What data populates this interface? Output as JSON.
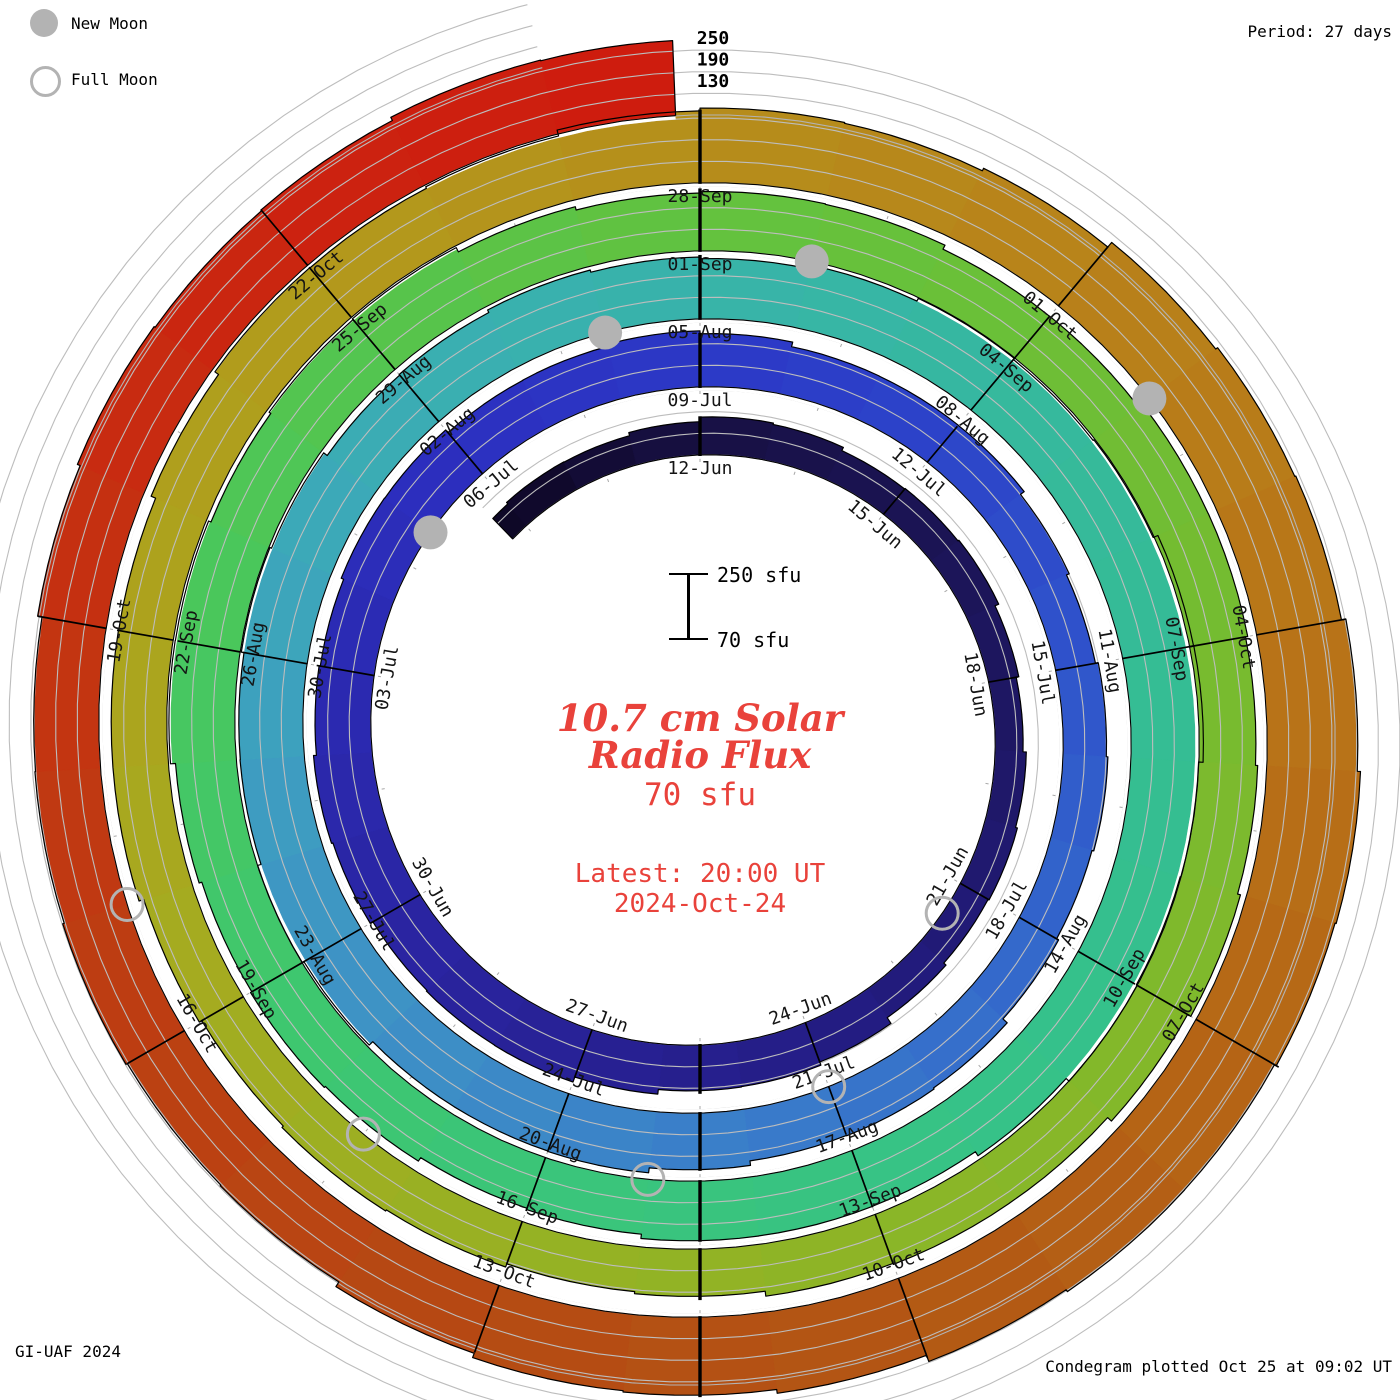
{
  "header": {
    "period_label": "Period: 27 days"
  },
  "legend": {
    "new_moon_label": "New Moon",
    "full_moon_label": "Full Moon"
  },
  "footer": {
    "left": "GI-UAF 2024",
    "right": "Condegram plotted Oct 25 at 09:02 UT"
  },
  "center": {
    "title_line1": "10.7 cm Solar",
    "title_line2": "Radio Flux",
    "baseline_value": "70 sfu",
    "latest_line1": "Latest: 20:00 UT",
    "latest_line2": "2024-Oct-24",
    "accent_color": "#e9423b"
  },
  "scale_bar": {
    "top_label": "250 sfu",
    "bottom_label": "70 sfu",
    "min_sfu": 70,
    "max_sfu": 250
  },
  "chart_data": {
    "type": "spiral",
    "title": "10.7 cm Solar Radio Flux condegram",
    "period_days": 27,
    "start_reference_date": "2024-06-12",
    "t_start": -3.3,
    "t_end": 134.83,
    "flux_min": 70,
    "flux_max": 250,
    "radial_axis_labels": [
      "250",
      "190",
      "130"
    ],
    "flux_keyframes": [
      [
        -3,
        150
      ],
      [
        0,
        172
      ],
      [
        3,
        162
      ],
      [
        6,
        152
      ],
      [
        9,
        162
      ],
      [
        12,
        188
      ],
      [
        15,
        212
      ],
      [
        18,
        228
      ],
      [
        21,
        232
      ],
      [
        24,
        225
      ],
      [
        27,
        215
      ],
      [
        30,
        200
      ],
      [
        33,
        190
      ],
      [
        36,
        196
      ],
      [
        39,
        212
      ],
      [
        42,
        238
      ],
      [
        45,
        258
      ],
      [
        48,
        252
      ],
      [
        51,
        238
      ],
      [
        54,
        242
      ],
      [
        57,
        258
      ],
      [
        60,
        268
      ],
      [
        63,
        252
      ],
      [
        66,
        238
      ],
      [
        69,
        228
      ],
      [
        72,
        232
      ],
      [
        75,
        246
      ],
      [
        78,
        252
      ],
      [
        81,
        238
      ],
      [
        84,
        222
      ],
      [
        87,
        228
      ],
      [
        90,
        238
      ],
      [
        93,
        216
      ],
      [
        96,
        196
      ],
      [
        99,
        206
      ],
      [
        102,
        228
      ],
      [
        105,
        252
      ],
      [
        108,
        268
      ],
      [
        111,
        285
      ],
      [
        114,
        322
      ],
      [
        117,
        335
      ],
      [
        120,
        305
      ],
      [
        123,
        268
      ],
      [
        126,
        252
      ],
      [
        129,
        262
      ],
      [
        132,
        272
      ],
      [
        135,
        272
      ]
    ],
    "color_stops": [
      [
        -3,
        "#0e0827"
      ],
      [
        0,
        "#171044"
      ],
      [
        6,
        "#1d1660"
      ],
      [
        12,
        "#241d85"
      ],
      [
        18,
        "#2a25a4"
      ],
      [
        24,
        "#2c2fc0"
      ],
      [
        27,
        "#2c38c6"
      ],
      [
        30,
        "#2c44c9"
      ],
      [
        33,
        "#2f54cb"
      ],
      [
        36,
        "#3366cb"
      ],
      [
        39,
        "#3877ca"
      ],
      [
        42,
        "#3c87c8"
      ],
      [
        45,
        "#3e95c4"
      ],
      [
        48,
        "#3da3bd"
      ],
      [
        51,
        "#3aaeb2"
      ],
      [
        54,
        "#38b3aa"
      ],
      [
        57,
        "#36b89f"
      ],
      [
        60,
        "#35bc95"
      ],
      [
        63,
        "#35c08c"
      ],
      [
        66,
        "#37c383"
      ],
      [
        69,
        "#3ac579"
      ],
      [
        72,
        "#3fc76d"
      ],
      [
        75,
        "#48c75e"
      ],
      [
        78,
        "#55c44d"
      ],
      [
        81,
        "#62c23f"
      ],
      [
        84,
        "#6cbf37"
      ],
      [
        87,
        "#76bb30"
      ],
      [
        90,
        "#81b82b"
      ],
      [
        93,
        "#8cb527"
      ],
      [
        96,
        "#97b123"
      ],
      [
        99,
        "#a3ac20"
      ],
      [
        102,
        "#aca41d"
      ],
      [
        105,
        "#b29a1c"
      ],
      [
        108,
        "#b68e1b"
      ],
      [
        111,
        "#b8821a"
      ],
      [
        114,
        "#b87518"
      ],
      [
        117,
        "#b56615"
      ],
      [
        120,
        "#b25714"
      ],
      [
        123,
        "#b54a13"
      ],
      [
        126,
        "#bc3f12"
      ],
      [
        129,
        "#c43311"
      ],
      [
        132,
        "#cb2310"
      ],
      [
        135,
        "#cf1a0e"
      ]
    ],
    "date_labels": [
      {
        "t": 0,
        "text": "12-Jun"
      },
      {
        "t": 3,
        "text": "15-Jun"
      },
      {
        "t": 6,
        "text": "18-Jun"
      },
      {
        "t": 9,
        "text": "21-Jun"
      },
      {
        "t": 12,
        "text": "24-Jun"
      },
      {
        "t": 15,
        "text": "27-Jun"
      },
      {
        "t": 18,
        "text": "30-Jun"
      },
      {
        "t": 21,
        "text": "03-Jul"
      },
      {
        "t": 24,
        "text": "06-Jul"
      },
      {
        "t": 27,
        "text": "09-Jul"
      },
      {
        "t": 30,
        "text": "12-Jul"
      },
      {
        "t": 33,
        "text": "15-Jul"
      },
      {
        "t": 36,
        "text": "18-Jul"
      },
      {
        "t": 39,
        "text": "21-Jul"
      },
      {
        "t": 42,
        "text": "24-Jul"
      },
      {
        "t": 45,
        "text": "27-Jul"
      },
      {
        "t": 48,
        "text": "30-Jul"
      },
      {
        "t": 51,
        "text": "02-Aug"
      },
      {
        "t": 54,
        "text": "05-Aug"
      },
      {
        "t": 57,
        "text": "08-Aug"
      },
      {
        "t": 60,
        "text": "11-Aug"
      },
      {
        "t": 63,
        "text": "14-Aug"
      },
      {
        "t": 66,
        "text": "17-Aug"
      },
      {
        "t": 69,
        "text": "20-Aug"
      },
      {
        "t": 72,
        "text": "23-Aug"
      },
      {
        "t": 75,
        "text": "26-Aug"
      },
      {
        "t": 78,
        "text": "29-Aug"
      },
      {
        "t": 81,
        "text": "01-Sep"
      },
      {
        "t": 84,
        "text": "04-Sep"
      },
      {
        "t": 87,
        "text": "07-Sep"
      },
      {
        "t": 90,
        "text": "10-Sep"
      },
      {
        "t": 93,
        "text": "13-Sep"
      },
      {
        "t": 96,
        "text": "16-Sep"
      },
      {
        "t": 99,
        "text": "19-Sep"
      },
      {
        "t": 102,
        "text": "22-Sep"
      },
      {
        "t": 105,
        "text": "25-Sep"
      },
      {
        "t": 108,
        "text": "28-Sep"
      },
      {
        "t": 111,
        "text": "01-Oct"
      },
      {
        "t": 114,
        "text": "04-Oct"
      },
      {
        "t": 117,
        "text": "07-Oct"
      },
      {
        "t": 120,
        "text": "10-Oct"
      },
      {
        "t": 123,
        "text": "13-Oct"
      },
      {
        "t": 126,
        "text": "16-Oct"
      },
      {
        "t": 129,
        "text": "19-Oct"
      },
      {
        "t": 132,
        "text": "22-Oct"
      }
    ],
    "new_moons": [
      {
        "t": 23,
        "date": "05-Jul"
      },
      {
        "t": 53,
        "date": "04-Aug"
      },
      {
        "t": 82,
        "date": "02-Sep"
      },
      {
        "t": 112,
        "date": "02-Oct"
      }
    ],
    "full_moons": [
      {
        "t": 9.5,
        "date": "21-Jun"
      },
      {
        "t": 39,
        "date": "21-Jul"
      },
      {
        "t": 68,
        "date": "19-Aug"
      },
      {
        "t": 97.5,
        "date": "17-Sep"
      },
      {
        "t": 127,
        "date": "17-Oct"
      }
    ],
    "moon_color": "#b3b3b3",
    "grid_color": "#bdbdbd",
    "px_per_sfu": 0.36
  }
}
